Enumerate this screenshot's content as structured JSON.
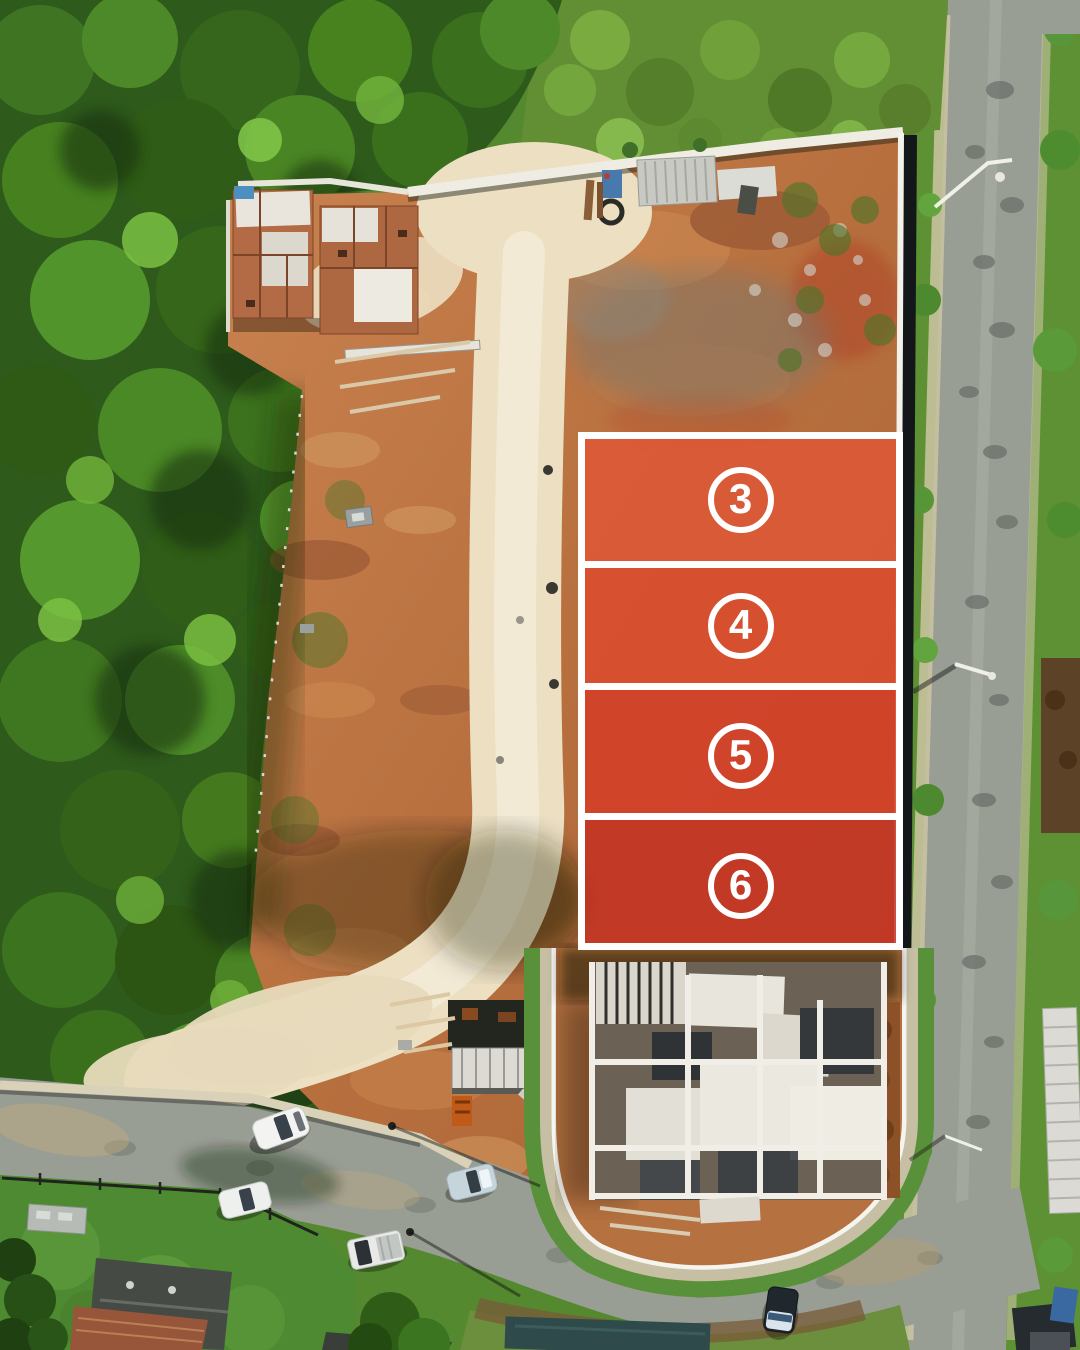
{
  "title": "Aerial drone view of a land development with numbered lots for sale",
  "lots": [
    {
      "id": "lot-3",
      "number": "3",
      "fill": "rgba(227,84,52,0.78)"
    },
    {
      "id": "lot-4",
      "number": "4",
      "fill": "rgba(222,73,44,0.80)"
    },
    {
      "id": "lot-5",
      "number": "5",
      "fill": "rgba(214,60,38,0.82)"
    },
    {
      "id": "lot-6",
      "number": "6",
      "fill": "rgba(197,49,33,0.84)"
    }
  ],
  "colors": {
    "lot_border": "#FFFFFF",
    "lot_badge_ring": "#FFFFFF",
    "lot_number_text": "#FFFFFF",
    "forest_green": "#2E5A1C",
    "grass_green": "#5E9334",
    "dirt_orange": "#C07A45",
    "sand_path": "#ECDFC2",
    "asphalt_gray": "#999E94",
    "wall_white": "#EFECE3"
  }
}
